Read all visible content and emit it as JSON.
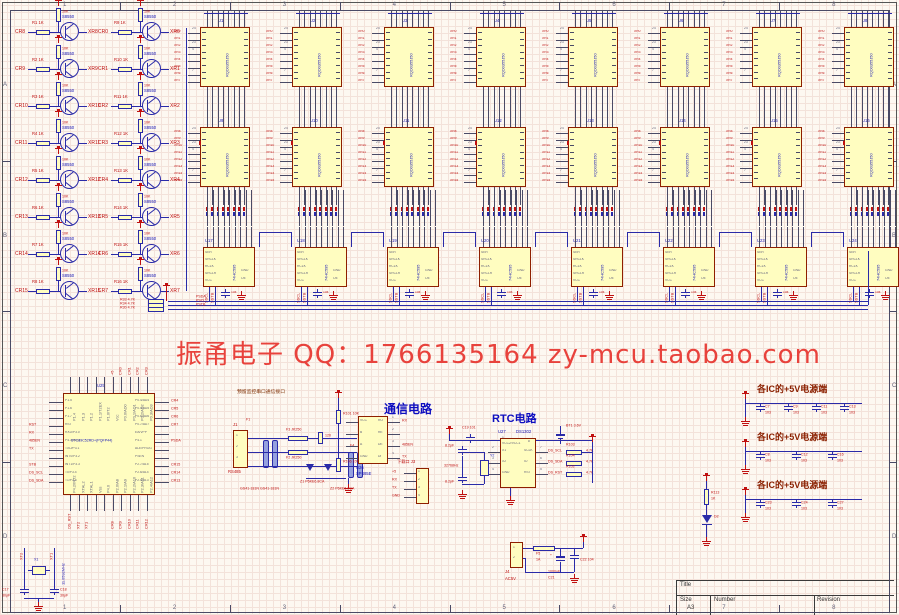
{
  "sheet": {
    "zones_top": [
      "1",
      "2",
      "3",
      "4",
      "5",
      "6",
      "7",
      "8"
    ],
    "zones_side": [
      "A",
      "B",
      "C",
      "D"
    ]
  },
  "watermark": {
    "text": "振甬电子 QQ：1766135164  zy-mcu.taobao.com"
  },
  "transistor_array": {
    "part": "S8550",
    "base_res_value": "1K",
    "pullup_value": "10K",
    "columns": [
      {
        "inputs": [
          "CR8",
          "CR9",
          "CR10",
          "CR11",
          "CR12",
          "CR13",
          "CR14",
          "CR15"
        ],
        "outputs": [
          "XR8",
          "XR9",
          "XR10",
          "XR11",
          "XR12",
          "XR13",
          "XR14",
          "XR15"
        ],
        "resistors": [
          "R1",
          "R2",
          "R3",
          "R4",
          "R5",
          "R6",
          "R7",
          "R8"
        ]
      },
      {
        "inputs": [
          "CR0",
          "CR1",
          "CR2",
          "CR3",
          "CR4",
          "CR5",
          "CR6",
          "CR7"
        ],
        "outputs": [
          "XR0",
          "XR1",
          "XR2",
          "XR3",
          "XR4",
          "XR5",
          "XR6",
          "XR7"
        ],
        "resistors": [
          "R9",
          "R10",
          "R11",
          "R12",
          "R13",
          "R14",
          "R15",
          "R16"
        ]
      }
    ]
  },
  "matrix_array": {
    "part": "RQD0355J50",
    "row1_refs": [
      "U1",
      "U2",
      "U3",
      "U4",
      "U5",
      "U6",
      "U7",
      "U8"
    ],
    "row2_refs": [
      "U9",
      "U10",
      "U11",
      "U12",
      "U13",
      "U14",
      "U15",
      "U16"
    ],
    "row1_nets": [
      "XR0",
      "XR1",
      "XR2",
      "XR3",
      "XR4",
      "XR5",
      "XR6",
      "XR7"
    ],
    "row2_nets": [
      "XR8",
      "XR9",
      "XR10",
      "XR11",
      "XR12",
      "XR13",
      "XR14",
      "XR15"
    ],
    "pin_numbers": [
      "24",
      "",
      "23",
      "4",
      "",
      "",
      "7",
      ""
    ]
  },
  "shift_registers": {
    "part": "74HC595",
    "refs": [
      "U17",
      "U18",
      "U19",
      "U20",
      "U21",
      "U22",
      "U23",
      "U24"
    ],
    "left_pins": [
      "SER",
      "SRCLK",
      "RCLK",
      "SRCLR",
      "VCC"
    ],
    "bottom_pins": [
      "GND",
      "OE"
    ],
    "cap_value": "104",
    "branch_nets": [
      "SSCL",
      "SSTB"
    ]
  },
  "bus": {
    "nets": [
      "PSDA",
      "PSCL",
      "PSTB"
    ],
    "pullups": [
      {
        "ref": "R33",
        "value": "4.7K"
      },
      {
        "ref": "R34",
        "value": "4.7K"
      },
      {
        "ref": "R30",
        "value": "4.7K"
      }
    ]
  },
  "mcu": {
    "ref": "U25",
    "part": "STC89C52RD+(PQFP44)",
    "left_pins": [
      "P1.5",
      "P1.6",
      "P1.7",
      "RST",
      "RXD/P3.0",
      "P4.3/INT3",
      "TXD/P3.1",
      "INT0/P3.2",
      "INT1/P3.3",
      "T0/P3.4",
      "T1/P3.5"
    ],
    "left_nets": [
      "",
      "",
      "",
      "RST",
      "RX",
      "485EN",
      "TX",
      "",
      "STB",
      "DS_SCL",
      "DS_SDA"
    ],
    "right_pins": [
      "P0.4/AD4",
      "P0.5/AD5",
      "P0.6/AD6",
      "P0.7/AD7",
      "EA/VPP",
      "P4.1",
      "ALE/PROG",
      "PSEN",
      "P2.7/A15",
      "P2.6/A14",
      "P2.5/A13"
    ],
    "right_nets": [
      "CR4",
      "CR5",
      "CR6",
      "CR7",
      "",
      "PSDA",
      "",
      "",
      "CR15",
      "CR14",
      "CR13"
    ],
    "top_pins": [
      "P1.4",
      "P1.3",
      "P1.2",
      "P1.1/T2EX",
      "P1.0/T2",
      "Vcc",
      "P0.0/AD0",
      "P0.1/AD1",
      "P0.2/AD2",
      "P0.3/AD3"
    ],
    "top_nets": [
      "",
      "",
      "",
      "",
      "",
      "+5",
      "CR0",
      "CR1",
      "CR2",
      "CR3"
    ],
    "bottom_pins": [
      "P4.2/INT2",
      "XTAL2",
      "XTAL1",
      "Vss",
      "P4.0",
      "P2.0/A8",
      "P2.1/A9",
      "P2.2/A10",
      "P2.3/A11",
      "P2.4/A12"
    ],
    "bottom_nets": [
      "DS_RST",
      "XT2",
      "XT1",
      "",
      "",
      "CR8",
      "CR9",
      "CR10",
      "CR11",
      "CR12"
    ]
  },
  "xtal": {
    "ref": "X1",
    "freq": "11.0592MHz",
    "c1_ref": "C17",
    "c1_val": "30pF",
    "c2_ref": "C18",
    "c2_val": "30pF",
    "nets": [
      "XT2",
      "XT1"
    ]
  },
  "comm": {
    "title": "通信电路",
    "note": "预留监控串口通信接口",
    "connector": {
      "ref": "J1",
      "label": "RS485"
    },
    "fuses": [
      {
        "ref": "F3",
        "part": "JK250"
      },
      {
        "ref": "F2",
        "part": "JK250"
      }
    ],
    "gdt_refs": [
      "F1",
      "F4"
    ],
    "gdt_note": "GS41-181N GS41-181N",
    "tvs_refs": [
      "Z1",
      "Z2"
    ],
    "tvs_note": "P6KE6.8CA",
    "terminator": {
      "ref": "R100",
      "value": "120"
    },
    "pullup": {
      "ref": "R101",
      "value": "10K"
    },
    "pulldown": {
      "ref": "R106",
      "value": "10K"
    },
    "ic": {
      "ref": "U26",
      "part": "SP485E",
      "left_pins": [
        "VCC",
        "B",
        "A",
        "GND"
      ],
      "right_pins": [
        "RO",
        "RE",
        "DE",
        "DI"
      ],
      "right_numbers": [
        "1",
        "2",
        "3",
        "4"
      ],
      "right_nets": [
        "RX",
        "",
        "485EN",
        "TX"
      ]
    }
  },
  "download": {
    "label": "下载口",
    "ref": "J3",
    "pins": [
      "+5",
      "RX",
      "TX",
      "GND"
    ]
  },
  "rtc": {
    "title": "RTC电路",
    "ic": {
      "ref": "U27",
      "part": "DS1302",
      "top_pin": "VCC2/VCC1",
      "left_pins": [
        "X1",
        "X2",
        "GND"
      ],
      "left_numbers": [
        "2",
        "3",
        "4"
      ],
      "right_pins": [
        "SCLK",
        "IO",
        "RST"
      ],
      "right_numbers": [
        "7",
        "6",
        "5"
      ],
      "right_nets": [
        "DS_SCL",
        "DS_SDA",
        "DS_RST"
      ]
    },
    "cap_in": {
      "ref": "C19",
      "val": "101"
    },
    "battery": {
      "ref": "BT1",
      "value": "3.6V"
    },
    "crystal": {
      "ref": "Y2",
      "value": "32768Hz"
    },
    "load_caps": [
      "8.2pF",
      "8.2pF"
    ],
    "resistors": [
      {
        "ref": "R103",
        "value": "4.7K"
      },
      {
        "ref": "R104",
        "value": "4.7K"
      },
      {
        "ref": "R102",
        "value": "4.7K"
      }
    ]
  },
  "power_banks": {
    "title": "各IC的+5V电源端",
    "banks": [
      [
        {
          "ref": "C7",
          "val": "103"
        },
        {
          "ref": "C9",
          "val": "103"
        },
        {
          "ref": "C11",
          "val": "103"
        },
        {
          "ref": "C13",
          "val": "103"
        }
      ],
      [
        {
          "ref": "C8",
          "val": "103"
        },
        {
          "ref": "C12",
          "val": "103"
        },
        {
          "ref": "C16",
          "val": "103"
        }
      ],
      [
        {
          "ref": "C23",
          "val": "103"
        },
        {
          "ref": "C24",
          "val": "103"
        },
        {
          "ref": "C27",
          "val": "103"
        }
      ]
    ]
  },
  "power_led": {
    "res_ref": "R113",
    "res_val": "1K",
    "led_ref": "D2"
  },
  "ac_input": {
    "conn_ref": "J4",
    "conn_label": "AC5V",
    "fuse_ref": "F5",
    "fuse_val": "1A",
    "cap1_ref": "C21",
    "cap1_val": "1000uF",
    "cap2_ref": "C22",
    "cap2_val": "104",
    "rail": "+5"
  },
  "title_block": {
    "title_label": "Title",
    "size_label": "Size",
    "size": "A3",
    "number_label": "Number",
    "revision_label": "Revision"
  }
}
